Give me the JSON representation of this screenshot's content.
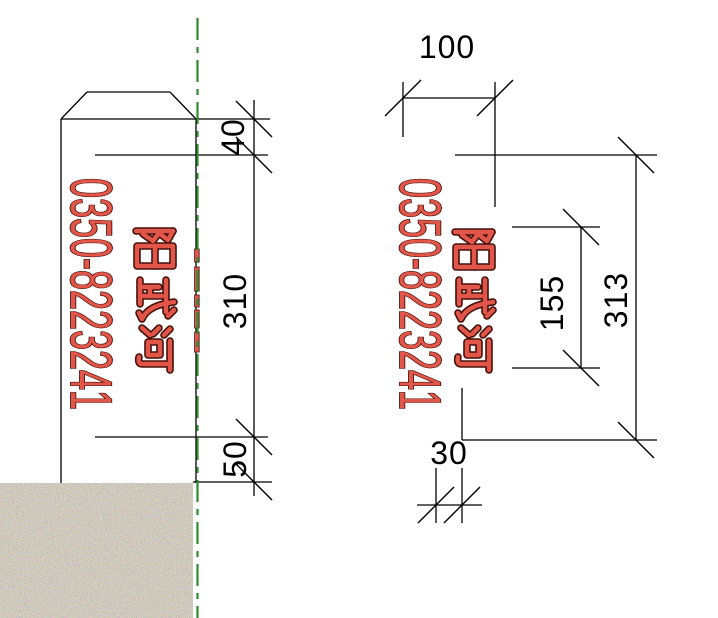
{
  "drawing_type": "marker-post elevation and section",
  "left_view": {
    "phone_number": "0350-8223241",
    "river_name": "阳武河",
    "dim_top": "40",
    "dim_middle": "310",
    "dim_bottom": "50"
  },
  "right_view": {
    "phone_number": "0350-8223241",
    "river_name": "阳武河",
    "dim_width": "100",
    "dim_inner_height": "155",
    "dim_total_height": "313",
    "dim_thickness": "30"
  },
  "colors": {
    "red_fill": "#e2564a",
    "red_outline": "#47110a",
    "green": "#2e8b2e",
    "line_black": "#000000"
  }
}
